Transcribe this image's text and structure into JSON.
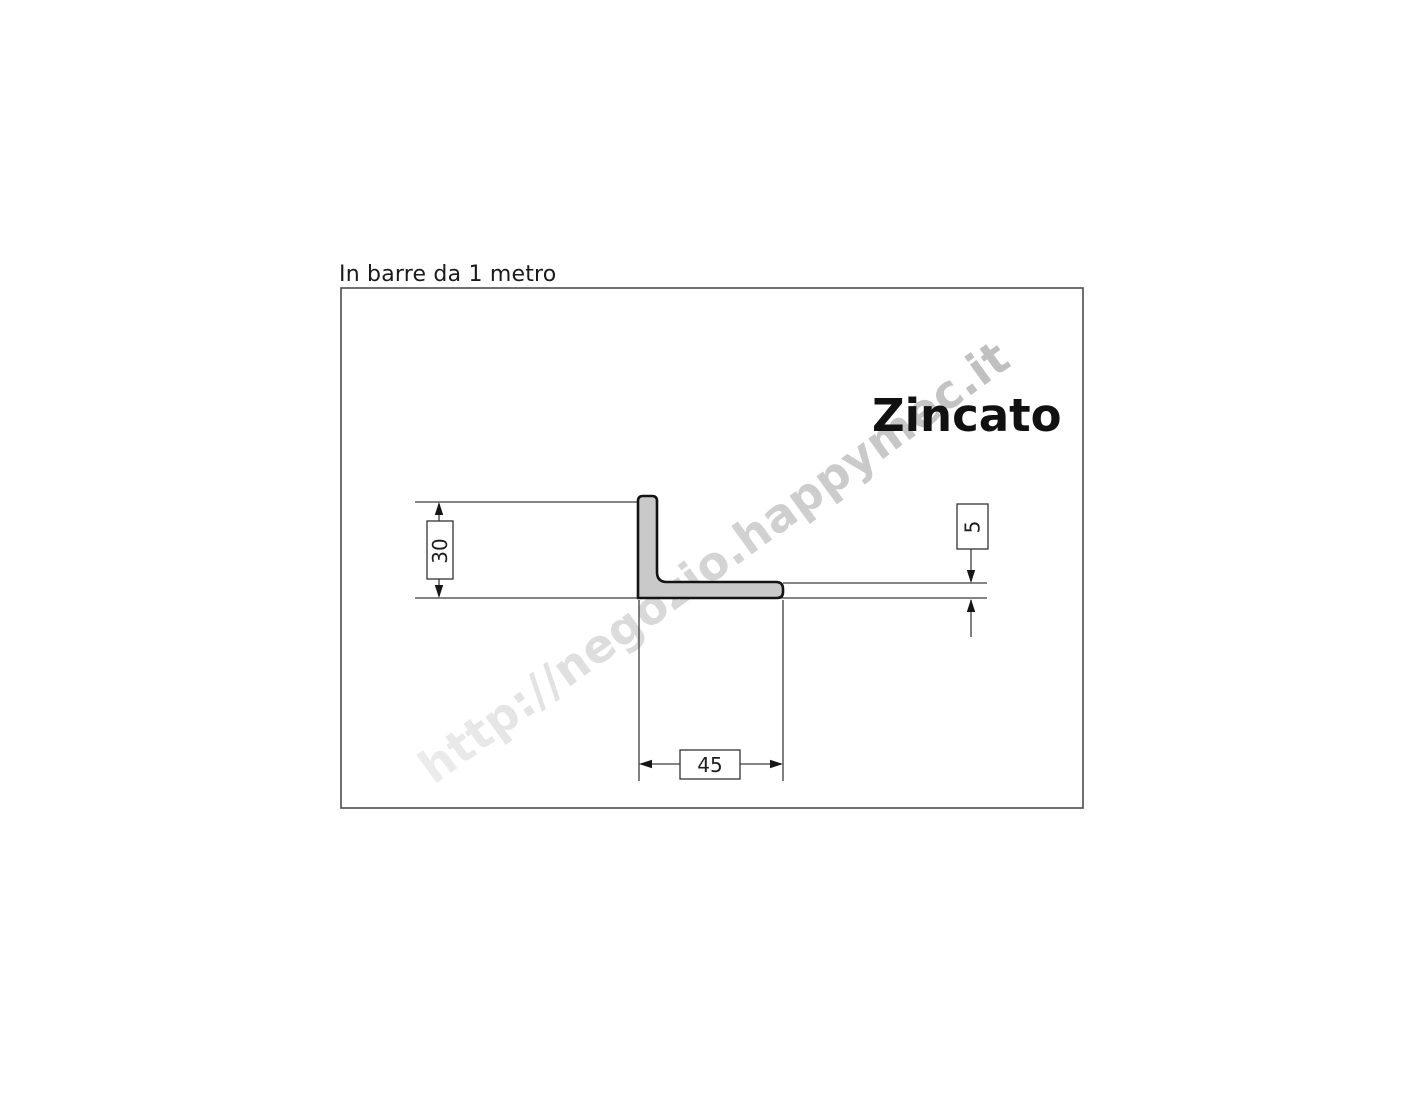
{
  "page": {
    "background": "#ffffff"
  },
  "title": "In barre da 1 metro",
  "watermark": "http://negozio.happymec.it",
  "drawing": {
    "finish_label": "Zincato",
    "profile_fill": "#c9c9c9",
    "outline_color": "#141414",
    "thin_line_color": "#3c3c3c",
    "dimensions": {
      "height_mm": "30",
      "width_mm": "45",
      "thickness_mm": "5"
    }
  }
}
